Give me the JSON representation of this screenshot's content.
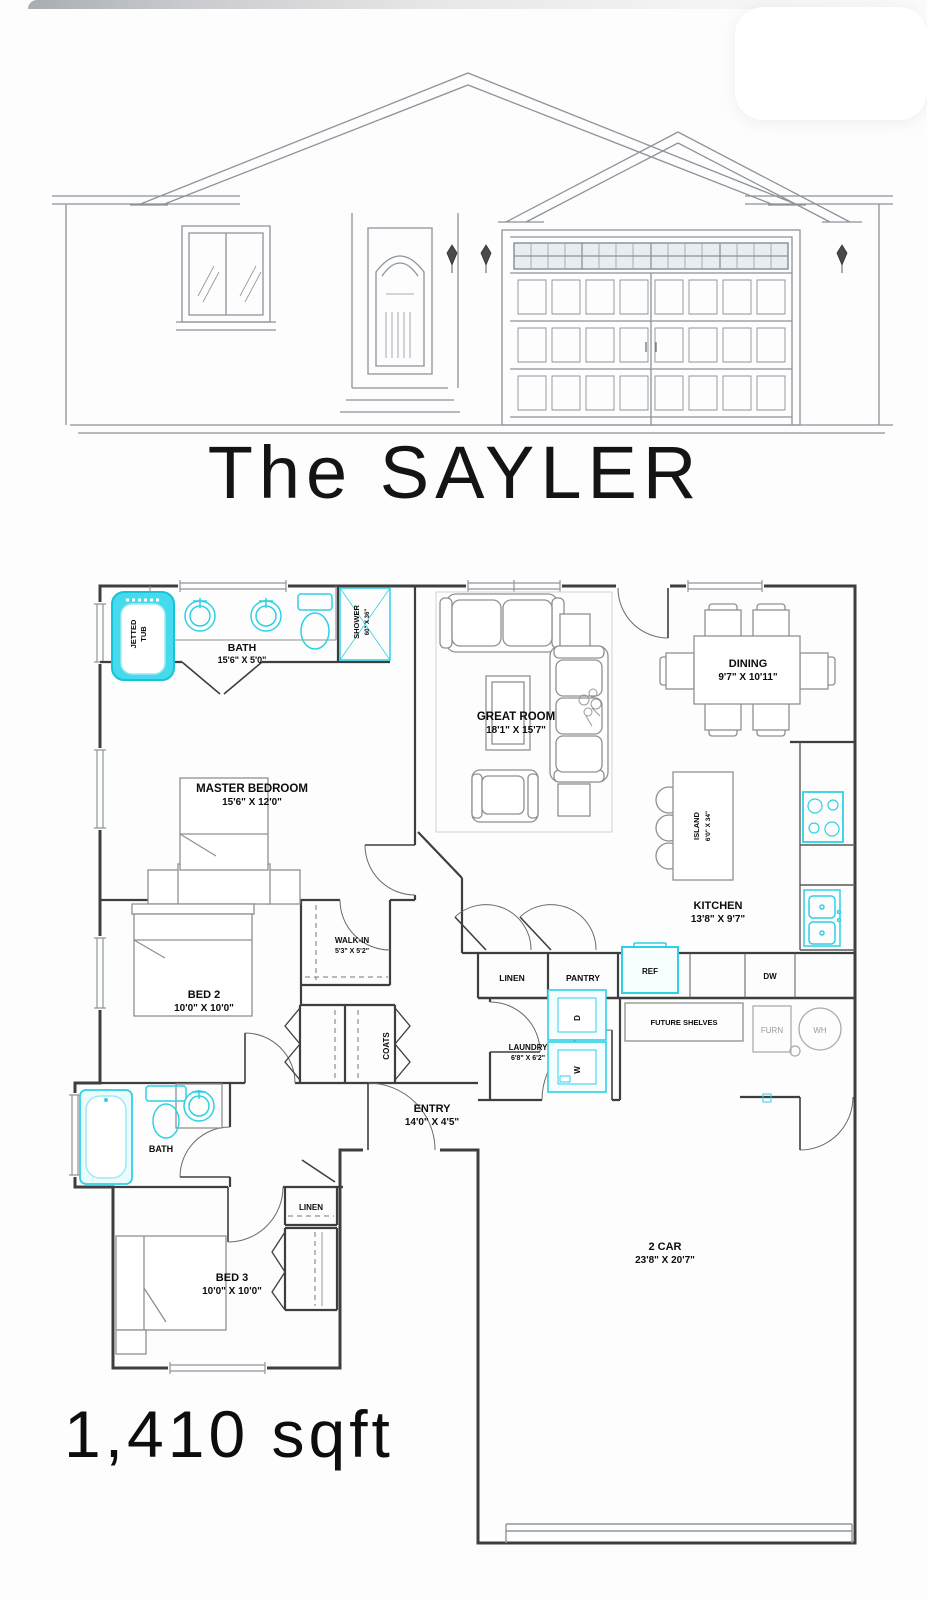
{
  "title": "The SAYLER",
  "footer": {
    "area": "1,410 sqft"
  },
  "overlay": {
    "pill_color": "#4b7fe3"
  },
  "colors": {
    "wall": "#3e3e3e",
    "fixture": "#2ed1e4",
    "furniture": "#909090",
    "elevation": "#8d939b",
    "label": "#0c0c0c"
  },
  "floorplan": {
    "master_bath": {
      "name": "BATH",
      "dims": "15'6\" X 5'0\""
    },
    "shower": {
      "name": "SHOWER",
      "dims": "60\" X 36\""
    },
    "jetted_tub": {
      "line1": "JETTED",
      "line2": "TUB"
    },
    "master_bedroom": {
      "name": "MASTER BEDROOM",
      "dims": "15'6\" X 12'0\""
    },
    "great_room": {
      "name": "GREAT ROOM",
      "dims": "18'1\" X 15'7\""
    },
    "dining": {
      "name": "DINING",
      "dims": "9'7\" X 10'11\""
    },
    "kitchen": {
      "name": "KITCHEN",
      "dims": "13'8\" X 9'7\""
    },
    "island": {
      "name": "ISLAND",
      "dims": "6'0\" X 34\""
    },
    "walk_in": {
      "name": "WALK-IN",
      "dims": "5'3\" X 5'2\""
    },
    "bed2": {
      "name": "BED 2",
      "dims": "10'0\" X 10'0\""
    },
    "bed3": {
      "name": "BED 3",
      "dims": "10'0\" X 10'0\""
    },
    "entry": {
      "name": "ENTRY",
      "dims": "14'0\" X 4'5\""
    },
    "laundry": {
      "name": "LAUNDRY",
      "dims": "6'8\" X 6'2\""
    },
    "garage": {
      "name": "2 CAR",
      "dims": "23'8\" X 20'7\""
    },
    "bath2": {
      "name": "BATH"
    },
    "closets": {
      "linen_kitchen": "LINEN",
      "pantry": "PANTRY",
      "coats": "COATS",
      "linen_hall": "LINEN",
      "future_shelves": "FUTURE SHELVES"
    },
    "appliances": {
      "ref": "REF",
      "dw": "DW",
      "furn": "FURN",
      "wh": "WH",
      "washer": "W",
      "dryer": "D"
    }
  }
}
